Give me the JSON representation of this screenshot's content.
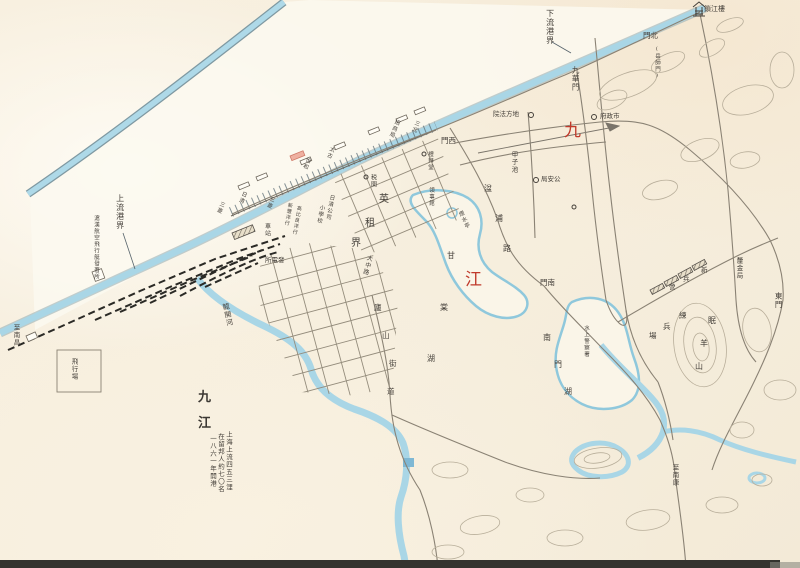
{
  "map": {
    "colors": {
      "paper": "#f6efde",
      "water": "#a9d6e6",
      "water_edge": "#7f99a2",
      "road": "#8a8274",
      "railway": "#2b2a26",
      "contour": "#b8ae9a",
      "label_ink": "#45403a",
      "city_name_red": "#c03a2b"
    },
    "legend": {
      "title_chars": [
        "九",
        "江"
      ],
      "lines": [
        "上海上流四五三浬",
        "在留邦人約七〇名",
        "一八六一年開港"
      ]
    },
    "labels": [
      {
        "t": "九",
        "x": 564,
        "y": 122,
        "m": "h",
        "s": 17,
        "c": "#c03a2b"
      },
      {
        "t": "江",
        "x": 465,
        "y": 271,
        "m": "h",
        "s": 17,
        "c": "#c03a2b"
      },
      {
        "t": "下流港界",
        "x": 545,
        "y": 9,
        "m": "v",
        "s": 8
      },
      {
        "t": "上流港界",
        "x": 115,
        "y": 194,
        "m": "v",
        "s": 8
      },
      {
        "t": "滬漢航空飛行艇發著所",
        "x": 92,
        "y": 215,
        "m": "v",
        "s": 5.5
      },
      {
        "t": "九華門",
        "x": 571,
        "y": 66,
        "m": "v",
        "s": 7.5
      },
      {
        "t": "北門",
        "x": 643,
        "y": 32,
        "m": "hr",
        "s": 7.5
      },
      {
        "t": "(岳師門)",
        "x": 653,
        "y": 46,
        "m": "v",
        "s": 5.5
      },
      {
        "t": "鎖江樓",
        "x": 704,
        "y": 6,
        "m": "h",
        "s": 7
      },
      {
        "t": "西門",
        "x": 441,
        "y": 137,
        "m": "hr",
        "s": 7.5
      },
      {
        "t": "南門",
        "x": 540,
        "y": 279,
        "m": "hr",
        "s": 7.5
      },
      {
        "t": "東門",
        "x": 774,
        "y": 292,
        "m": "v",
        "s": 7.5
      },
      {
        "t": "地方法院",
        "x": 493,
        "y": 111,
        "m": "hr",
        "s": 6.5
      },
      {
        "t": "市政府",
        "x": 600,
        "y": 113,
        "m": "hr",
        "s": 6.5
      },
      {
        "t": "公安局",
        "x": 541,
        "y": 176,
        "m": "hr",
        "s": 6.5
      },
      {
        "t": "甲子池",
        "x": 510,
        "y": 151,
        "m": "v",
        "s": 6.5
      },
      {
        "t": "湓浦路",
        "m": "c",
        "s": 8,
        "chars": [
          [
            484,
            185
          ],
          [
            495,
            215
          ],
          [
            503,
            245
          ]
        ]
      },
      {
        "t": "甘棠湖",
        "m": "c",
        "s": 8,
        "chars": [
          [
            447,
            252
          ],
          [
            440,
            304
          ],
          [
            427,
            355
          ]
        ]
      },
      {
        "t": "南門湖",
        "m": "c",
        "s": 8,
        "chars": [
          [
            543,
            334
          ],
          [
            554,
            361
          ],
          [
            564,
            388
          ]
        ]
      },
      {
        "t": "煙水亭",
        "x": 456,
        "y": 213,
        "m": "v",
        "s": 5.5,
        "rot": -25
      },
      {
        "t": "英租界",
        "m": "c",
        "s": 10,
        "chars": [
          [
            379,
            195
          ],
          [
            365,
            219
          ],
          [
            351,
            239
          ]
        ]
      },
      {
        "t": "税関",
        "x": 369,
        "y": 174,
        "m": "v",
        "s": 6
      },
      {
        "t": "禮拜堂",
        "x": 426,
        "y": 151,
        "m": "v",
        "s": 5.5
      },
      {
        "t": "領事館",
        "x": 427,
        "y": 187,
        "m": "v",
        "s": 5.5
      },
      {
        "t": "招商局",
        "x": 394,
        "y": 118,
        "m": "v",
        "s": 5.5,
        "rot": 22
      },
      {
        "t": "三北",
        "x": 414,
        "y": 119,
        "m": "v",
        "s": 5.5,
        "rot": 22
      },
      {
        "t": "太古",
        "x": 329,
        "y": 145,
        "m": "v",
        "s": 5.5,
        "rot": 22
      },
      {
        "t": "怡和",
        "x": 305,
        "y": 156,
        "m": "v",
        "s": 5.5,
        "rot": 22
      },
      {
        "t": "日清",
        "x": 241,
        "y": 190,
        "m": "v",
        "s": 5.5,
        "rot": 22
      },
      {
        "t": "三菱",
        "x": 219,
        "y": 200,
        "m": "v",
        "s": 5.5,
        "rot": 22
      },
      {
        "t": "三菱",
        "x": 269,
        "y": 195,
        "m": "v",
        "s": 5.5,
        "rot": 22
      },
      {
        "t": "日清公司",
        "x": 328,
        "y": 194,
        "m": "v",
        "s": 5.5,
        "rot": 10
      },
      {
        "t": "小學校",
        "x": 318,
        "y": 204,
        "m": "v",
        "s": 5.5,
        "rot": 10
      },
      {
        "t": "新豐洋行",
        "x": 287,
        "y": 202,
        "m": "v",
        "s": 5,
        "rot": 10
      },
      {
        "t": "高比良洋行",
        "x": 296,
        "y": 205,
        "m": "v",
        "s": 5,
        "rot": 10
      },
      {
        "t": "車站",
        "x": 263,
        "y": 223,
        "m": "v",
        "s": 6
      },
      {
        "t": "發電所",
        "x": 265,
        "y": 257,
        "m": "hr",
        "s": 6.5
      },
      {
        "t": "龍開河",
        "x": 221,
        "y": 304,
        "m": "v",
        "s": 7,
        "rot": -12
      },
      {
        "t": "大中路",
        "x": 366,
        "y": 254,
        "m": "v",
        "s": 6,
        "rot": 15
      },
      {
        "t": "廬山街道",
        "m": "c",
        "s": 7.5,
        "chars": [
          [
            374,
            304
          ],
          [
            382,
            332
          ],
          [
            389,
            360
          ],
          [
            387,
            388
          ]
        ]
      },
      {
        "t": "至南昌",
        "x": 12,
        "y": 324,
        "m": "v",
        "s": 6.5
      },
      {
        "t": "飛行場",
        "x": 70,
        "y": 358,
        "m": "v",
        "s": 6.5
      },
      {
        "t": "至南康",
        "x": 671,
        "y": 464,
        "m": "v",
        "s": 6.5
      },
      {
        "t": "水上警察署",
        "x": 582,
        "y": 325,
        "m": "v",
        "s": 5.5
      },
      {
        "t": "練兵場",
        "m": "c",
        "s": 7.5,
        "chars": [
          [
            679,
            312
          ],
          [
            663,
            323
          ],
          [
            649,
            332
          ]
        ]
      },
      {
        "t": "新兵營",
        "m": "c",
        "s": 6.5,
        "chars": [
          [
            701,
            267
          ],
          [
            683,
            276
          ],
          [
            669,
            284
          ]
        ]
      },
      {
        "t": "眠羊山",
        "m": "c",
        "s": 8,
        "chars": [
          [
            708,
            317
          ],
          [
            700,
            340
          ],
          [
            695,
            363
          ]
        ]
      },
      {
        "t": "釐金局",
        "x": 735,
        "y": 257,
        "m": "v",
        "s": 6.5
      }
    ]
  }
}
